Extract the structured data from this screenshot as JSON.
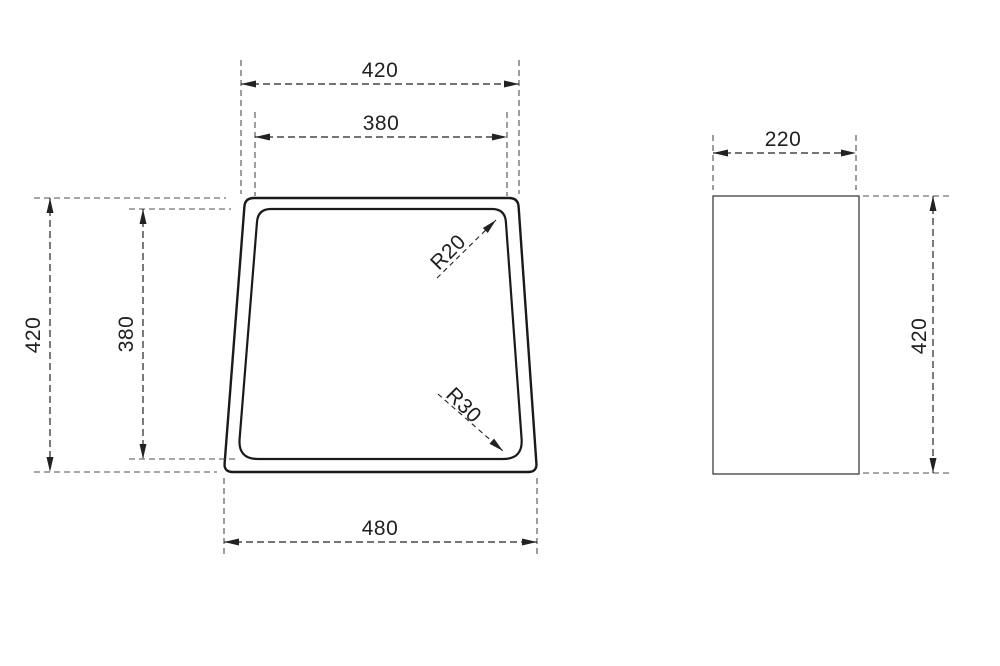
{
  "front_view": {
    "top_width_outer": "420",
    "top_width_inner": "380",
    "height_outer": "420",
    "height_inner": "380",
    "bottom_width": "480",
    "corner_radius_top": "R20",
    "corner_radius_bottom": "R30"
  },
  "side_view": {
    "width": "220",
    "height": "420"
  },
  "colors": {
    "background": "#ffffff",
    "outline": "#1a1a1a",
    "side_outline": "#4a4a4a",
    "dimension_line": "#222222",
    "extension_line": "#4f4f4f",
    "label_text": "#1f1f1f"
  }
}
